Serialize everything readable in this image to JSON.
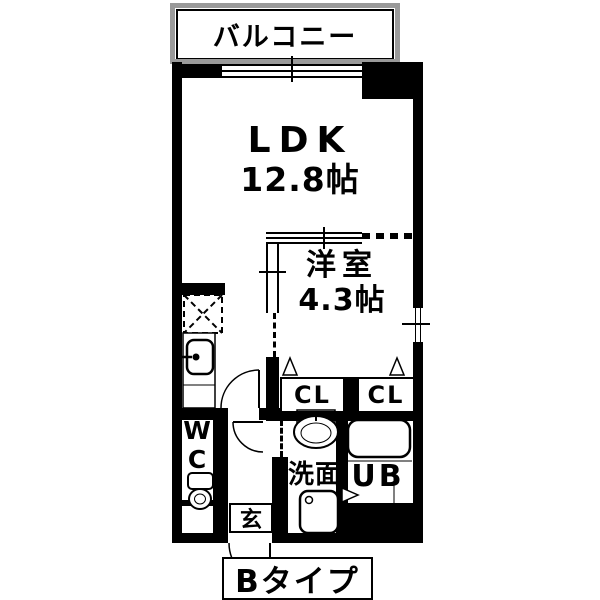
{
  "floor_plan": {
    "balcony": {
      "label": "バルコニー"
    },
    "ldk": {
      "name": "LDK",
      "size": "12.8帖"
    },
    "western_room": {
      "name": "洋室",
      "size": "4.3帖"
    },
    "closets": {
      "left": "CL",
      "right": "CL"
    },
    "toilet_room": {
      "letter_top": "W",
      "letter_bottom": "C"
    },
    "washroom": {
      "label": "洗面"
    },
    "unit_bath": {
      "label": "UB"
    },
    "entrance": {
      "label": "玄"
    },
    "plan_type": {
      "label": "Bタイプ"
    },
    "colors": {
      "wall": "#000000",
      "background": "#ffffff",
      "balcony_frame": "#9a9a9a"
    }
  }
}
